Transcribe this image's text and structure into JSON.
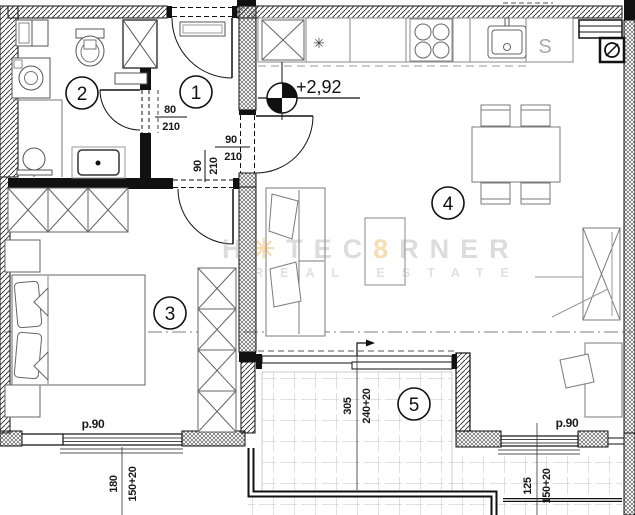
{
  "rooms": {
    "r1": "1",
    "r2": "2",
    "r3": "3",
    "r4": "4",
    "r5": "5"
  },
  "level": {
    "value": "+2,92"
  },
  "dimensions": {
    "bath_door": {
      "width": "80",
      "height": "210"
    },
    "living_door": {
      "width": "90",
      "height": "210"
    },
    "bedroom_door": {
      "width": "90",
      "height": "210"
    },
    "balcony_door": {
      "width": "305",
      "height": "240+20"
    },
    "bedroom_window": {
      "width": "180",
      "height": "150+20"
    },
    "living_window": {
      "width": "125",
      "height": "150+20"
    },
    "parapet_bedroom": "p.90",
    "parapet_living": "p.90"
  },
  "kitchen": {
    "sink": "S",
    "fridge": "✳"
  },
  "watermark": {
    "p1": "H",
    "star": "✳",
    "p2": "TEC",
    "amp": "8",
    "p3": "RNER",
    "line2": "REAL ESTATE"
  }
}
